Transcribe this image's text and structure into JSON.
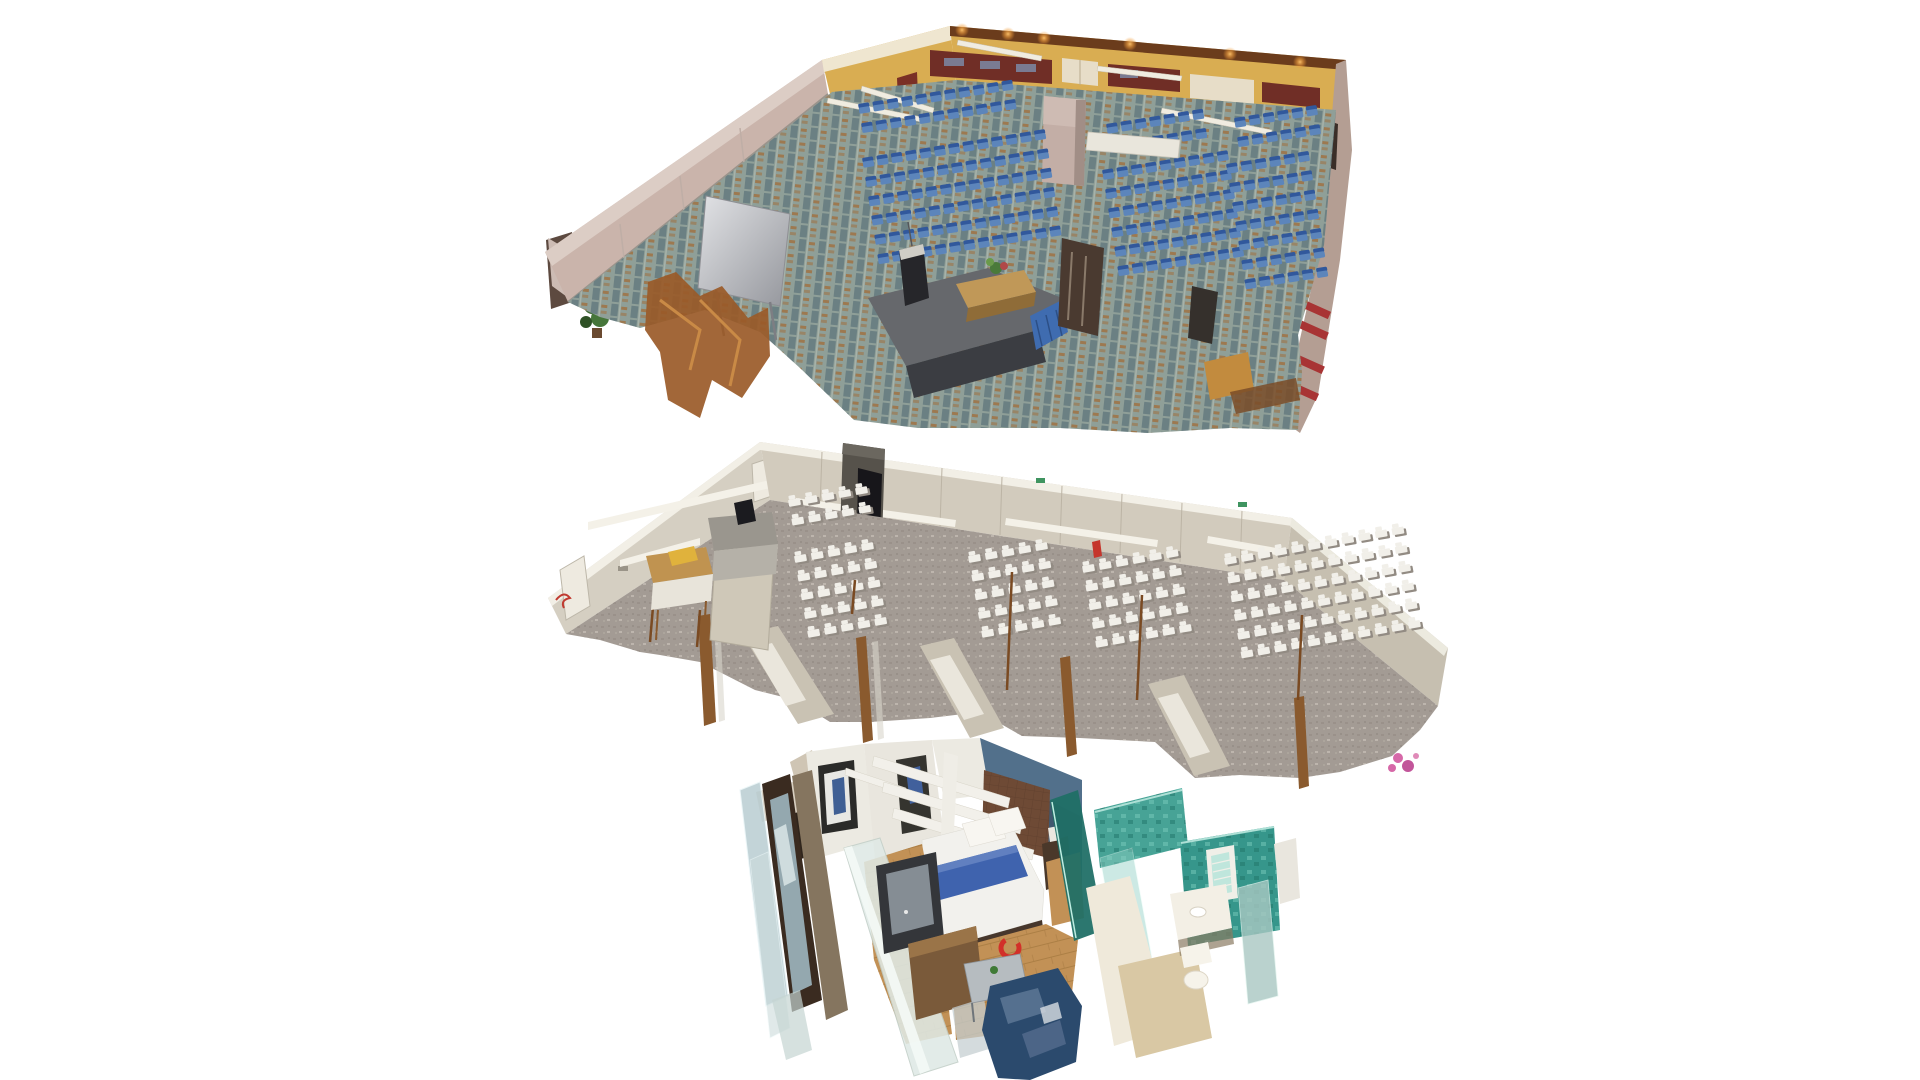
{
  "canvas": {
    "width": 1920,
    "height": 1080,
    "background": "#ffffff"
  },
  "scenes": [
    {
      "id": "conference-hall",
      "label": "3D dollhouse scan - conference hall with rows of blue chairs, patterned carpet and stage",
      "palette": {
        "carpet": "#8f9f98",
        "wall_yellow": "#d9ad52",
        "wall_cream": "#efe6d0",
        "wall_cap_brown": "#6b3c1c",
        "wall_maroon": "#702e26",
        "wall_pink": "#cab4ab",
        "wall_mauve": "#b49e93",
        "stage": "#66686c",
        "stage_front": "#3b3d42",
        "stage_skirt": "#3f6cb0",
        "table_wood": "#c09858",
        "chair_seat": "#5c85bb",
        "chair_back": "#31589c",
        "stripe_red": "#a83434"
      },
      "chair_style": "blue-seats",
      "chair_blocks": [
        {
          "name": "back-left-rows",
          "x": 858,
          "y": 104,
          "rows": 2,
          "cols": 11,
          "dx": 14.5,
          "dy": 19.5,
          "w": 11,
          "h": 10,
          "rot": -9
        },
        {
          "name": "main-left-block",
          "x": 862,
          "y": 158,
          "rows": 6,
          "cols": 13,
          "dx": 14.5,
          "dy": 19.5,
          "w": 11,
          "h": 10,
          "rot": -9
        },
        {
          "name": "back-center-rows",
          "x": 1106,
          "y": 124,
          "rows": 2,
          "cols": 7,
          "dx": 14.5,
          "dy": 19.5,
          "w": 11,
          "h": 10,
          "rot": -9
        },
        {
          "name": "center-block",
          "x": 1102,
          "y": 170,
          "rows": 6,
          "cols": 9,
          "dx": 14.5,
          "dy": 19.5,
          "w": 11,
          "h": 10,
          "rot": -9
        },
        {
          "name": "back-right-rows",
          "x": 1234,
          "y": 118,
          "rows": 2,
          "cols": 6,
          "dx": 14.5,
          "dy": 19.5,
          "w": 11,
          "h": 10,
          "rot": -9
        },
        {
          "name": "right-block",
          "x": 1226,
          "y": 164,
          "rows": 7,
          "cols": 6,
          "dx": 14.5,
          "dy": 19.5,
          "w": 11,
          "h": 10,
          "rot": -9
        }
      ]
    },
    {
      "id": "meeting-room",
      "label": "3D dollhouse scan - meeting room with rows of white classroom tables and chairs",
      "palette": {
        "carpet": "#a39b94",
        "wall": "#d2cbbd",
        "wall_left": "#d5cfc2",
        "wall_end": "#c6bfb0",
        "wall_top": "#f2efe6",
        "chair": "#f1efe9",
        "chair_shadow": "#928b83",
        "extinguisher_red": "#c5352c",
        "exit_green": "#3f9460",
        "wood_trim": "#8a5a2e",
        "flower_pink": "#d668a8"
      },
      "chair_style": "white-units",
      "chair_blocks": [
        {
          "name": "back-left-rows",
          "x": 788,
          "y": 500,
          "rows": 2,
          "cols": 5,
          "dx": 17,
          "dy": 19,
          "w": 12,
          "h": 7,
          "rot": -10
        },
        {
          "name": "section-1",
          "x": 794,
          "y": 556,
          "rows": 5,
          "cols": 5,
          "dx": 17,
          "dy": 19,
          "w": 12,
          "h": 7,
          "rot": -10
        },
        {
          "name": "section-2",
          "x": 968,
          "y": 556,
          "rows": 5,
          "cols": 5,
          "dx": 17,
          "dy": 19,
          "w": 12,
          "h": 7,
          "rot": -10
        },
        {
          "name": "section-3",
          "x": 1082,
          "y": 566,
          "rows": 5,
          "cols": 6,
          "dx": 17,
          "dy": 19,
          "w": 12,
          "h": 7,
          "rot": -10
        },
        {
          "name": "section-4",
          "x": 1224,
          "y": 558,
          "rows": 6,
          "cols": 11,
          "dx": 17,
          "dy": 19,
          "w": 12,
          "h": 7,
          "rot": -10
        }
      ]
    },
    {
      "id": "hotel-room",
      "label": "3D dollhouse scan - hotel room with bed, lounge, mirrored wardrobe and teal en-suite bathroom",
      "palette": {
        "floor": "#c29156",
        "wall": "#eceae2",
        "wall_slate": "#52708b",
        "headboard": "#6e4a35",
        "bed_white": "#f2f1ed",
        "bed_blue": "#3f63ae",
        "sofa": "#2b4a6d",
        "bath_teal": "#36968b",
        "bath_teal_dark": "#1f6e66",
        "bath_floor": "#d9c8a4",
        "glass": "#dfe9e5",
        "logo_red": "#d23029"
      }
    }
  ]
}
